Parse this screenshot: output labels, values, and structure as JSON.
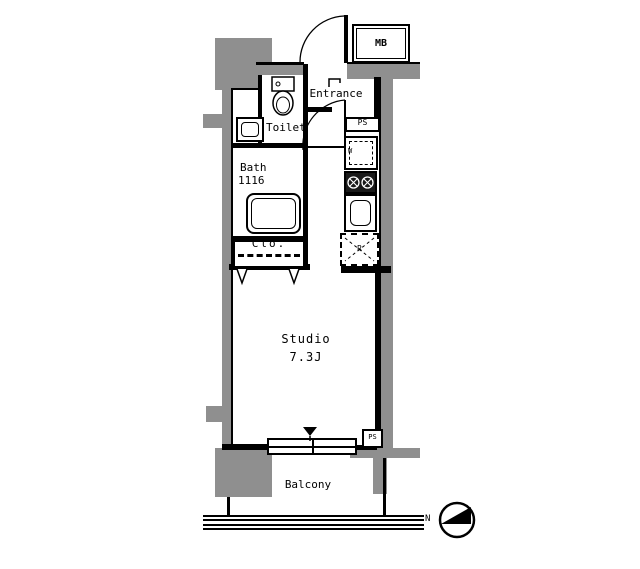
{
  "rooms": {
    "entrance": {
      "label": "Entrance"
    },
    "toilet": {
      "label": "Toilet"
    },
    "bath": {
      "label": "Bath",
      "size": "1116"
    },
    "closet": {
      "label": "Clo."
    },
    "studio": {
      "label": "Studio",
      "area": "7.3J"
    },
    "balcony": {
      "label": "Balcony"
    }
  },
  "equipment": {
    "meter_box": "MB",
    "pipe_shaft_upper": "PS",
    "pipe_shaft_lower": "PS",
    "washing_machine": "W",
    "refrigerator": "R"
  },
  "compass": {
    "north": "N"
  },
  "colors": {
    "wall": "#000000",
    "concrete": "#8f8f8f",
    "background": "#ffffff"
  }
}
